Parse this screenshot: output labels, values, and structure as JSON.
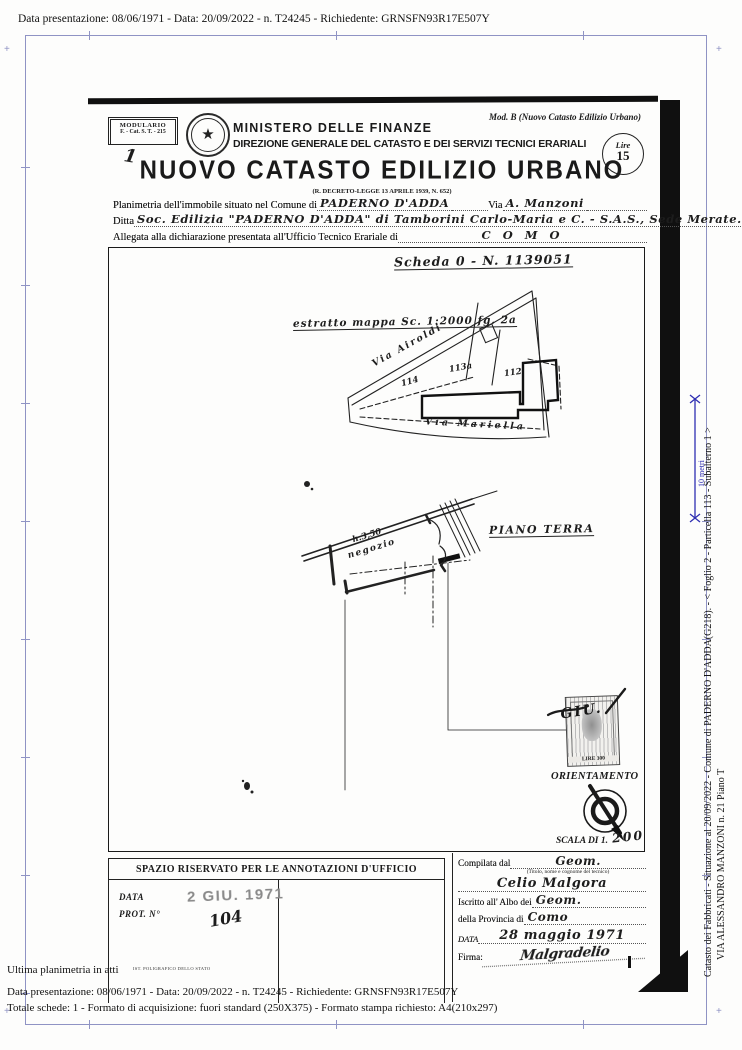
{
  "viewer": {
    "header_line": "Data presentazione: 08/06/1971 - Data: 20/09/2022 - n. T24245 - Richiedente: GRNSFN93R17E507Y",
    "footer": {
      "line1": "Ultima planimetria in atti",
      "line2": "Data presentazione: 08/06/1971 - Data: 20/09/2022 - n. T24245 - Richiedente: GRNSFN93R17E507Y",
      "line3": "Totale schede: 1 - Formato di acquisizione: fuori standard (250X375) - Formato stampa richiesto: A4(210x297)"
    },
    "sidebar": {
      "line1": "Catasto dei Fabbricati - Situazione al 20/09/2022 - Comune di PADERNO D'ADDA(G218). - <  Foglio 2 - Particella 113 - Subalterno 1  >",
      "line2": "VIA ALESSANDRO MANZONI n. 21 Piano T",
      "scale_label": "10 metri"
    },
    "colors": {
      "frame": "#8f93c4",
      "scalebar": "#2f2fb2"
    }
  },
  "doc": {
    "modulario_line1": "MODULARIO",
    "modulario_line2": "F. - Cat. S. T. - 215",
    "mod_b": "Mod. B (Nuovo Catasto Edilizio Urbano)",
    "emblem_glyph": "★",
    "ministero": "MINISTERO DELLE FINANZE",
    "direzione": "DIREZIONE GENERALE DEL CATASTO E DEI SERVIZI TECNICI ERARIALI",
    "bollo_lire": "Lire",
    "bollo_value": "15",
    "title": "NUOVO CATASTO EDILIZIO URBANO",
    "law_line": "(R. DECRETO-LEGGE 13 APRILE 1939, N. 652)",
    "handmark": "1",
    "f1_label": "Planimetria dell'immobile situato nel Comune di",
    "f1_value": "PADERNO D'ADDA",
    "f1b_label": "Via",
    "f1b_value": "A. Manzoni",
    "f2_label": "Ditta",
    "f2_value": "Soc. Edilizia \"PADERNO D'ADDA\" di Tamborini Carlo-Maria e C. - S.A.S., Sede Merate.",
    "f3_label": "Allegata alla dichiarazione presentata all'Ufficio Tecnico Erariale di",
    "f3_value": "C O M O",
    "scheda_note": "Scheda 0 - N. 1139051",
    "map_note": "estratto mappa Sc. 1:2000 fg. 2a",
    "street_top": "Via Airoldi",
    "street_bottom": "Via Mariella",
    "parcel_left": "114",
    "parcel_mid": "113a",
    "parcel_right": "112",
    "plan_title": "PIANO TERRA",
    "room_height": "h.3,50",
    "room_label": "negozio",
    "stamp_value": "LIRE 300",
    "stamp_cancel": "GIU.",
    "orient_label": "ORIENTAMENTO",
    "scala_label": "SCALA DI 1.",
    "scala_value": "200",
    "ann_header": "SPAZIO RISERVATO PER LE ANNOTAZIONI D'UFFICIO",
    "ann_data_label": "DATA",
    "ann_prot_label": "PROT. N°",
    "ann_date_stamp": "2 GIU. 1971",
    "ann_prot_value": "104",
    "comp_l1": "Compilata dal",
    "comp_l1_value": "Geom.",
    "comp_l1_sub": "(Titolo, nome e cognome del tecnico)",
    "comp_name": "Celio Malgora",
    "comp_l3": "Iscritto all' Albo dei",
    "comp_l3_value": "Geom.",
    "comp_l4": "della Provincia di",
    "comp_l4_value": "Como",
    "comp_l5": "DATA",
    "comp_l5_value": "28 maggio 1971",
    "comp_l6": "Firma:",
    "comp_signature": "Malgradelio",
    "print_footer": "IST. POLIGRAFICO DELLO STATO"
  }
}
